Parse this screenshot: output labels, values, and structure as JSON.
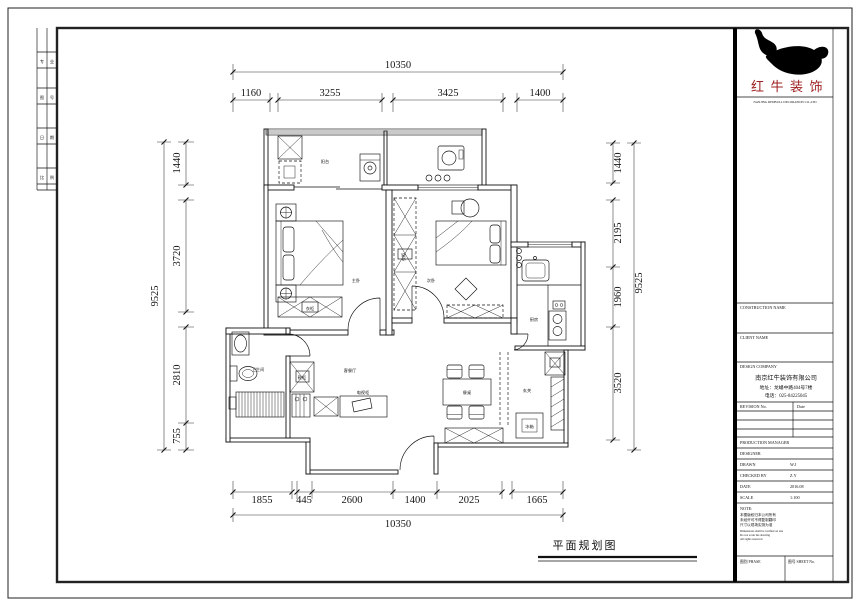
{
  "footer": {
    "drawing_title": "平面规划图"
  },
  "frame_strip": [
    {
      "a": "专",
      "b": "业"
    },
    {
      "a": "图",
      "b": "号"
    },
    {
      "a": "日",
      "b": "期"
    },
    {
      "a": "比",
      "b": "例"
    }
  ],
  "dims": {
    "top_total": "10350",
    "top": [
      "1160",
      "3255",
      "3425",
      "1400"
    ],
    "left_total": "9525",
    "left": [
      "1440",
      "3720",
      "2810",
      "755"
    ],
    "right_total": "9525",
    "right": [
      "1440",
      "2195",
      "1960",
      "3520"
    ],
    "bottom_total": "10350",
    "bottom": [
      "1855",
      "445",
      "2600",
      "1400",
      "2025",
      "1665"
    ]
  },
  "plan": {
    "rooms": [
      "阳台",
      "主卧",
      "次卧",
      "厨房",
      "卫生间",
      "客餐厅",
      "玄关"
    ],
    "furniture": [
      "衣柜",
      "衣柜",
      "餐桌",
      "冰箱",
      "鞋柜",
      "电视柜"
    ]
  },
  "title_block": {
    "logo_text": "红牛装饰",
    "logo_tagline": "NANJING REDBULL DECORATION CO.,LTD",
    "label_construction": "CONSTRUCTION NAME",
    "label_client": "CLIENT NAME",
    "label_design_co": "DESIGN COMPANY",
    "company_name": "南京红牛装饰有限公司",
    "company_address": "地址：龙蟠中路404号7楼",
    "company_phone": "电话：025-84225045",
    "revision_no": "REVISION No.",
    "revision_date": "Date",
    "rows": [
      {
        "label": "PRODUCTION MANAGER",
        "value": ""
      },
      {
        "label": "DESIGNER",
        "value": ""
      },
      {
        "label": "DRAWN",
        "value": "W.J"
      },
      {
        "label": "CHECKED BY",
        "value": "Z.Y"
      },
      {
        "label": "DATE",
        "value": "2016.08"
      },
      {
        "label": "SCALE",
        "value": "1:100"
      }
    ],
    "note_title": "NOTE:",
    "notes": [
      "本图版权归本公司所有",
      "未经许可不得复制翻印",
      "尺寸以现场实测为准"
    ],
    "notes_small": [
      "Dimensions shall be verified on site",
      "Do not scale the drawing",
      "All rights reserved"
    ],
    "cell_phase": "图别 PHASE",
    "cell_sheet": "图号 SHEET No."
  }
}
